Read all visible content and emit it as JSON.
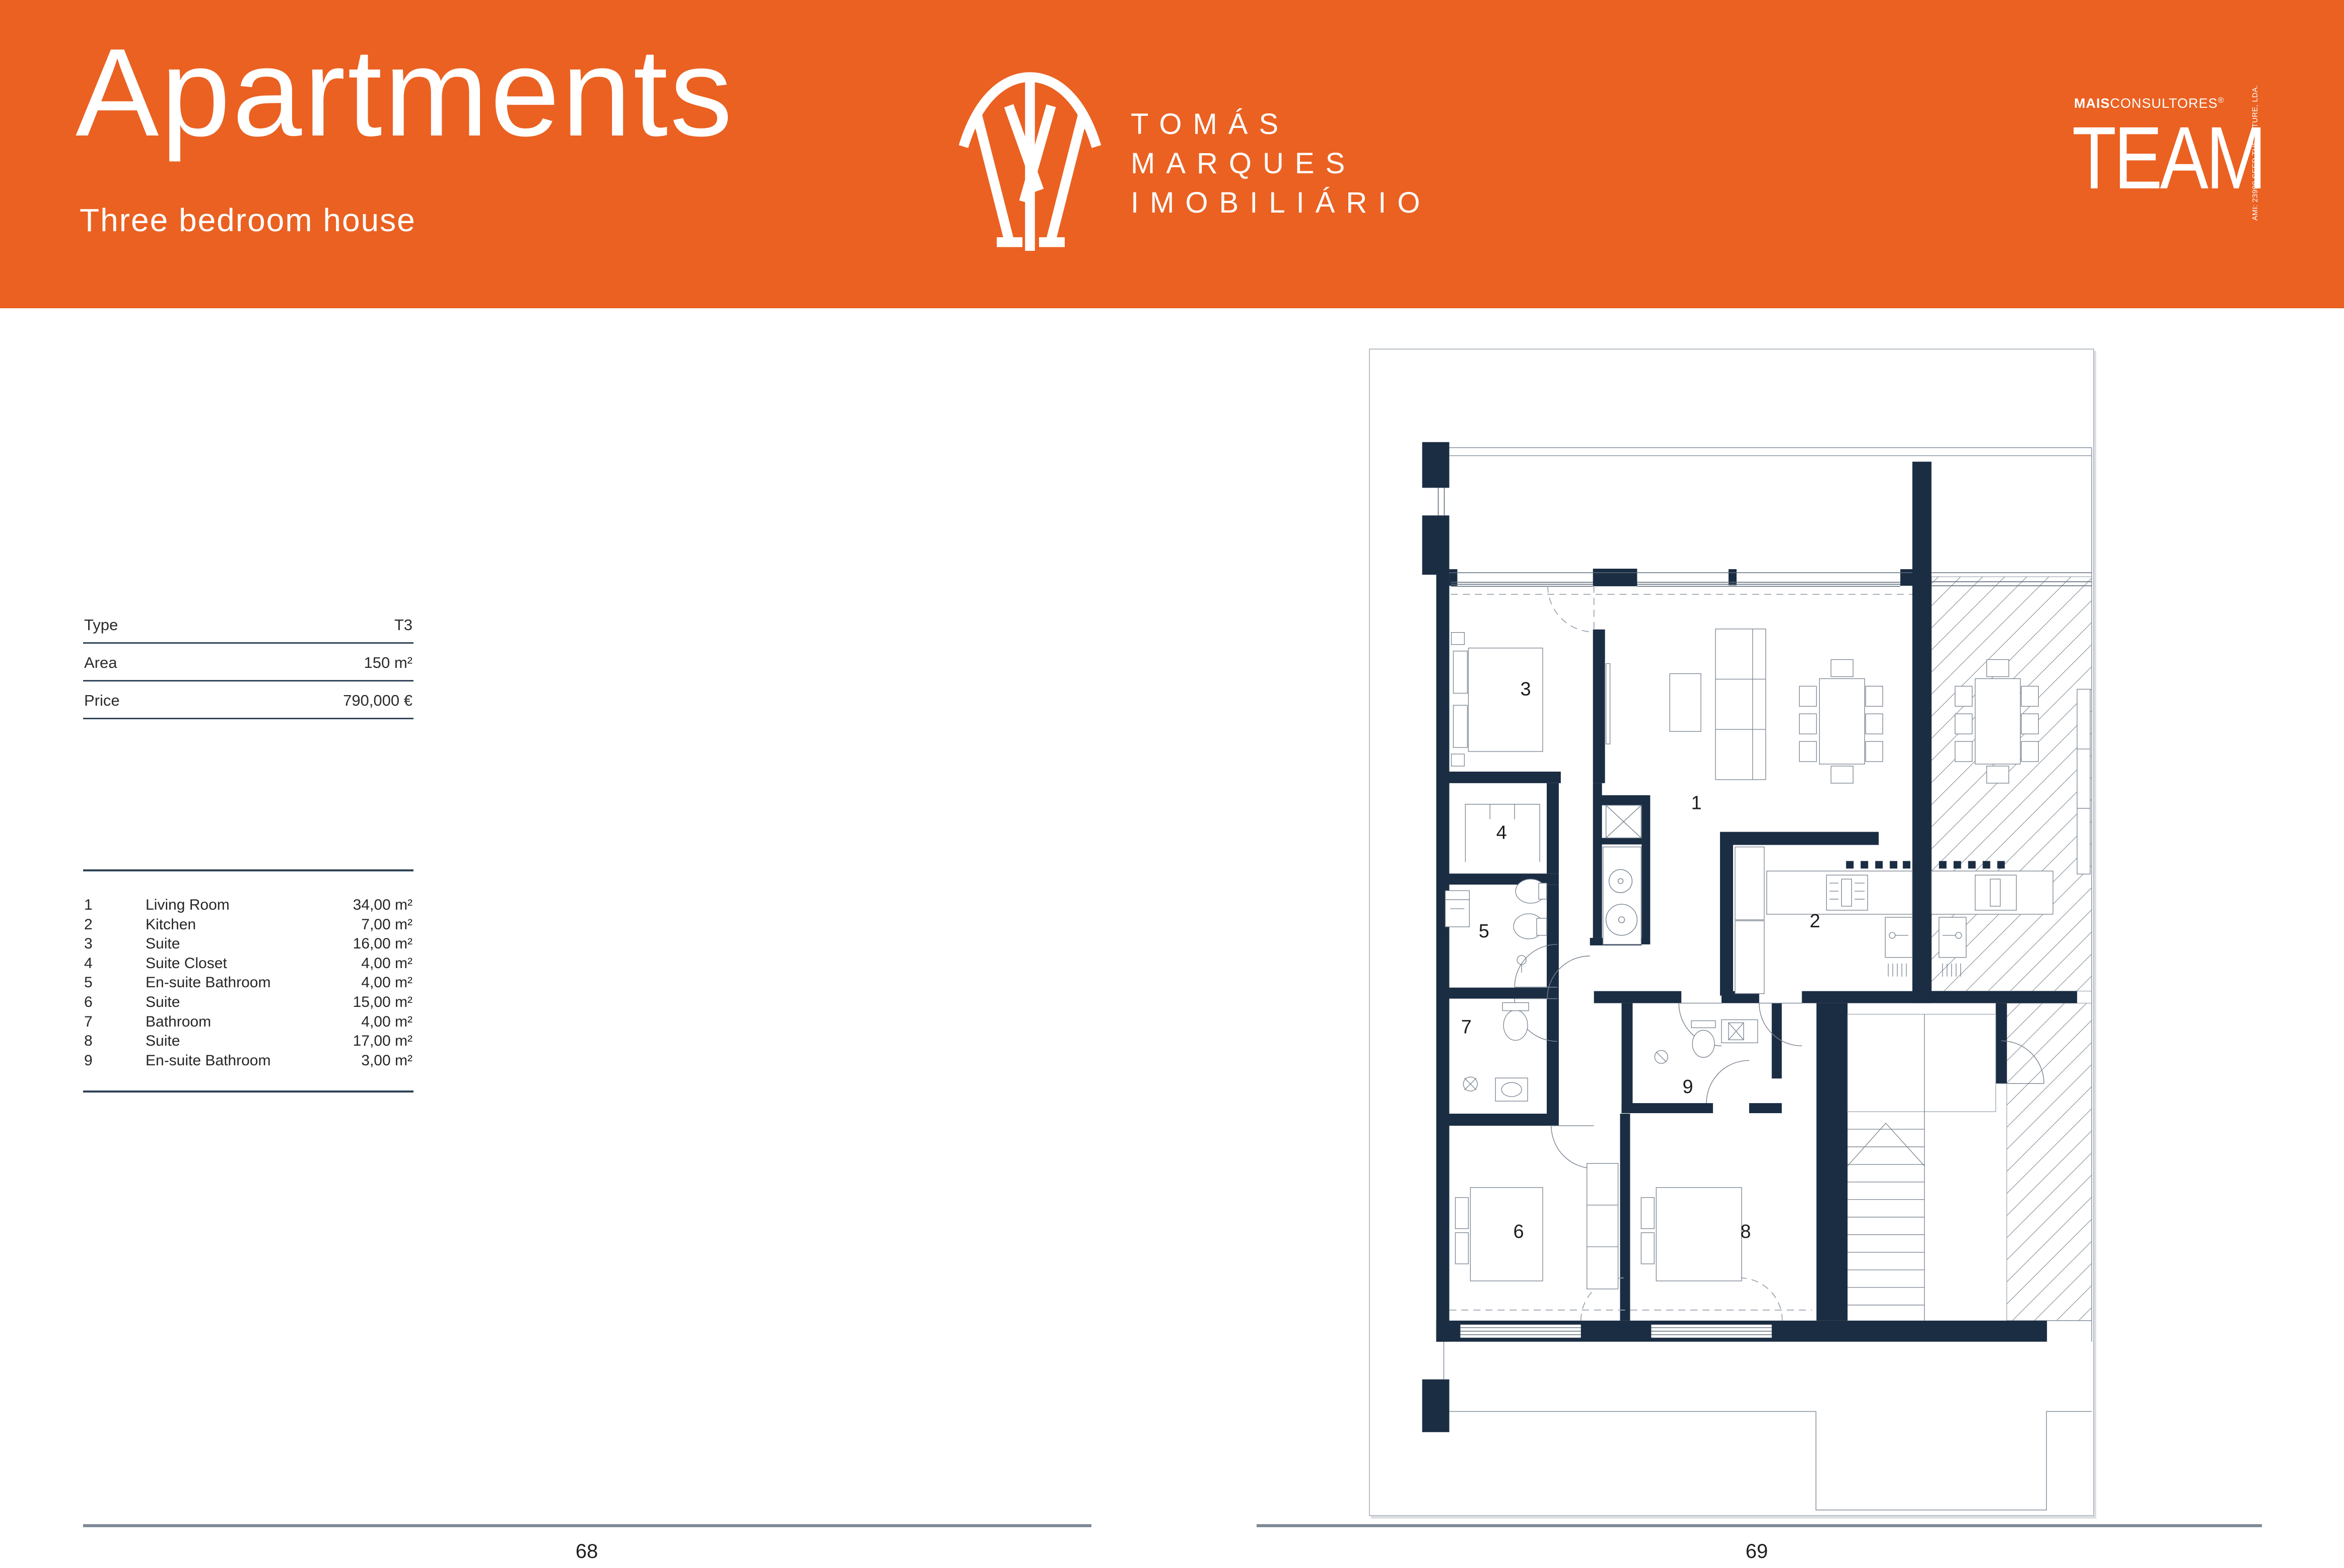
{
  "header": {
    "title": "Apartments",
    "subtitle": "Three bedroom house",
    "brand": {
      "line1": "TOMÁS",
      "line2": "MARQUES",
      "line3": "IMOBILIÁRIO"
    },
    "team": {
      "top_bold": "MAIS",
      "top_light": "CONSULTORES",
      "reg": "®",
      "wordmark": "TEAM",
      "side_text": "AMI: 23990  SEED THE FUTURE, LDA."
    }
  },
  "info": {
    "rows": [
      {
        "label": "Type",
        "value": "T3"
      },
      {
        "label": "Area",
        "value": "150 m²"
      },
      {
        "label": "Price",
        "value": "790,000 €"
      }
    ]
  },
  "legend": {
    "rows": [
      {
        "num": "1",
        "name": "Living Room",
        "area": "34,00 m²"
      },
      {
        "num": "2",
        "name": "Kitchen",
        "area": "7,00 m²"
      },
      {
        "num": "3",
        "name": "Suite",
        "area": "16,00 m²"
      },
      {
        "num": "4",
        "name": "Suite Closet",
        "area": "4,00 m²"
      },
      {
        "num": "5",
        "name": "En-suite Bathroom",
        "area": "4,00 m²"
      },
      {
        "num": "6",
        "name": "Suite",
        "area": "15,00 m²"
      },
      {
        "num": "7",
        "name": "Bathroom",
        "area": "4,00 m²"
      },
      {
        "num": "8",
        "name": "Suite",
        "area": "17,00 m²"
      },
      {
        "num": "9",
        "name": "En-suite Bathroom",
        "area": "3,00 m²"
      }
    ]
  },
  "plan": {
    "labels": [
      {
        "text": "1"
      },
      {
        "text": "2"
      },
      {
        "text": "3"
      },
      {
        "text": "4"
      },
      {
        "text": "5"
      },
      {
        "text": "6"
      },
      {
        "text": "7"
      },
      {
        "text": "8"
      },
      {
        "text": "9"
      }
    ]
  },
  "footer": {
    "left_page": "68",
    "right_page": "69"
  },
  "colors": {
    "accent_orange": "#EA6122",
    "plan_wall_navy": "#1B2D43",
    "table_divider": "#33465A",
    "footer_line": "#7E8A96"
  }
}
